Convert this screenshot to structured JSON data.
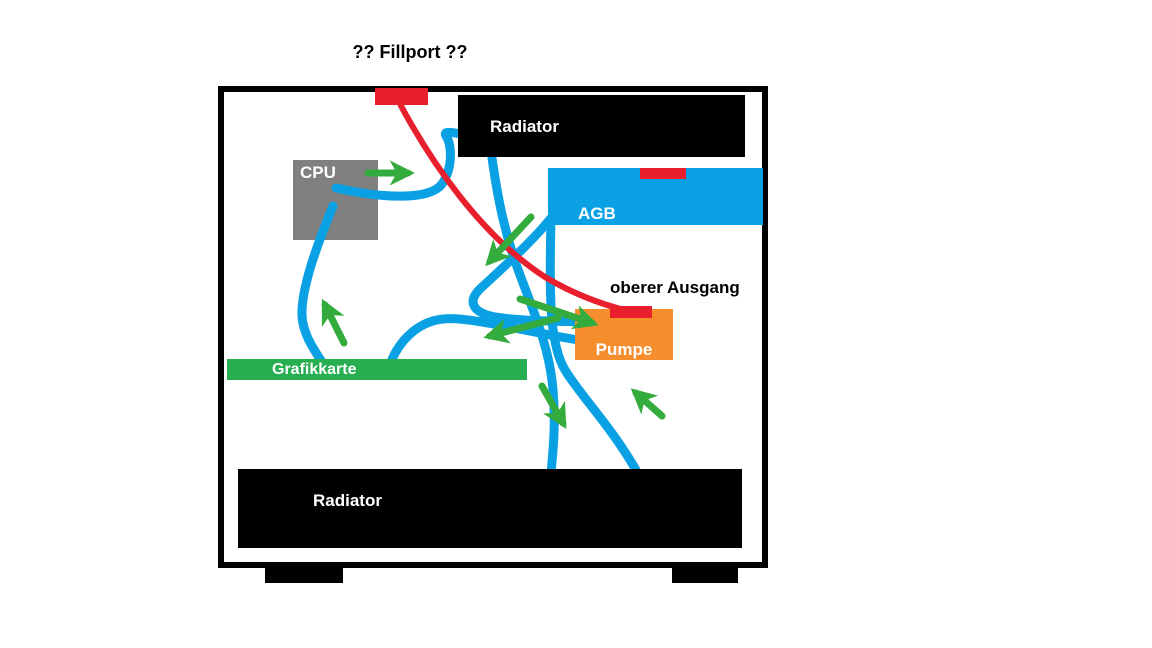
{
  "annotations": {
    "fillport_question": "?? Fillport ??",
    "upper_output": "oberer Ausgang"
  },
  "components": {
    "top_radiator": {
      "label": "Radiator"
    },
    "bottom_radiator": {
      "label": "Radiator"
    },
    "agb": {
      "label": "AGB"
    },
    "cpu": {
      "label": "CPU"
    },
    "pump": {
      "label": "Pumpe"
    },
    "gpu": {
      "label": "Grafikkarte"
    }
  },
  "flow_arrows": [
    {
      "at": "cpu-to-top-radiator",
      "direction": "right"
    },
    {
      "at": "gpu-to-cpu",
      "direction": "up"
    },
    {
      "at": "pump-to-gpu",
      "direction": "left"
    },
    {
      "at": "into-pump-inlet",
      "direction": "down-right"
    },
    {
      "at": "agb-outlet",
      "direction": "down-left"
    },
    {
      "at": "down-to-bottom-radiator",
      "direction": "down-right"
    },
    {
      "at": "from-bottom-radiator",
      "direction": "up-left"
    }
  ],
  "colors": {
    "tube_blue": "#0AA1E4",
    "arrow_green": "#33AB3D",
    "gpu_green": "#27AE50",
    "fill_red": "#E8202D",
    "pump_orange": "#F78E2E",
    "cpu_gray": "#808080",
    "case_black": "#000000",
    "label_white": "#FFFFFF",
    "label_black": "#000000"
  }
}
